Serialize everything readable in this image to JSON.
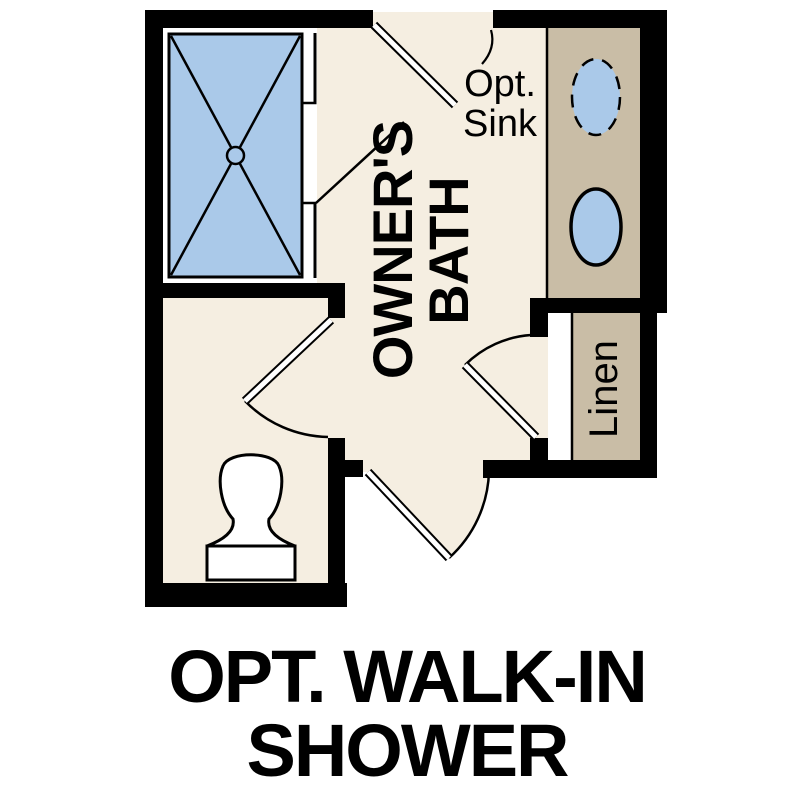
{
  "colors": {
    "wall": "#000000",
    "floor": "#f5eee1",
    "counter": "#c9bda6",
    "fixture": "#aac9e9",
    "line": "#000000",
    "background": "#ffffff"
  },
  "plan": {
    "room_label": {
      "line1": "OWNER'S",
      "line2": "BATH"
    },
    "opt_sink_label": {
      "line1": "Opt.",
      "line2": "Sink"
    },
    "linen_label": "Linen"
  },
  "caption": {
    "line1": "OPT. WALK-IN",
    "line2": "SHOWER"
  }
}
